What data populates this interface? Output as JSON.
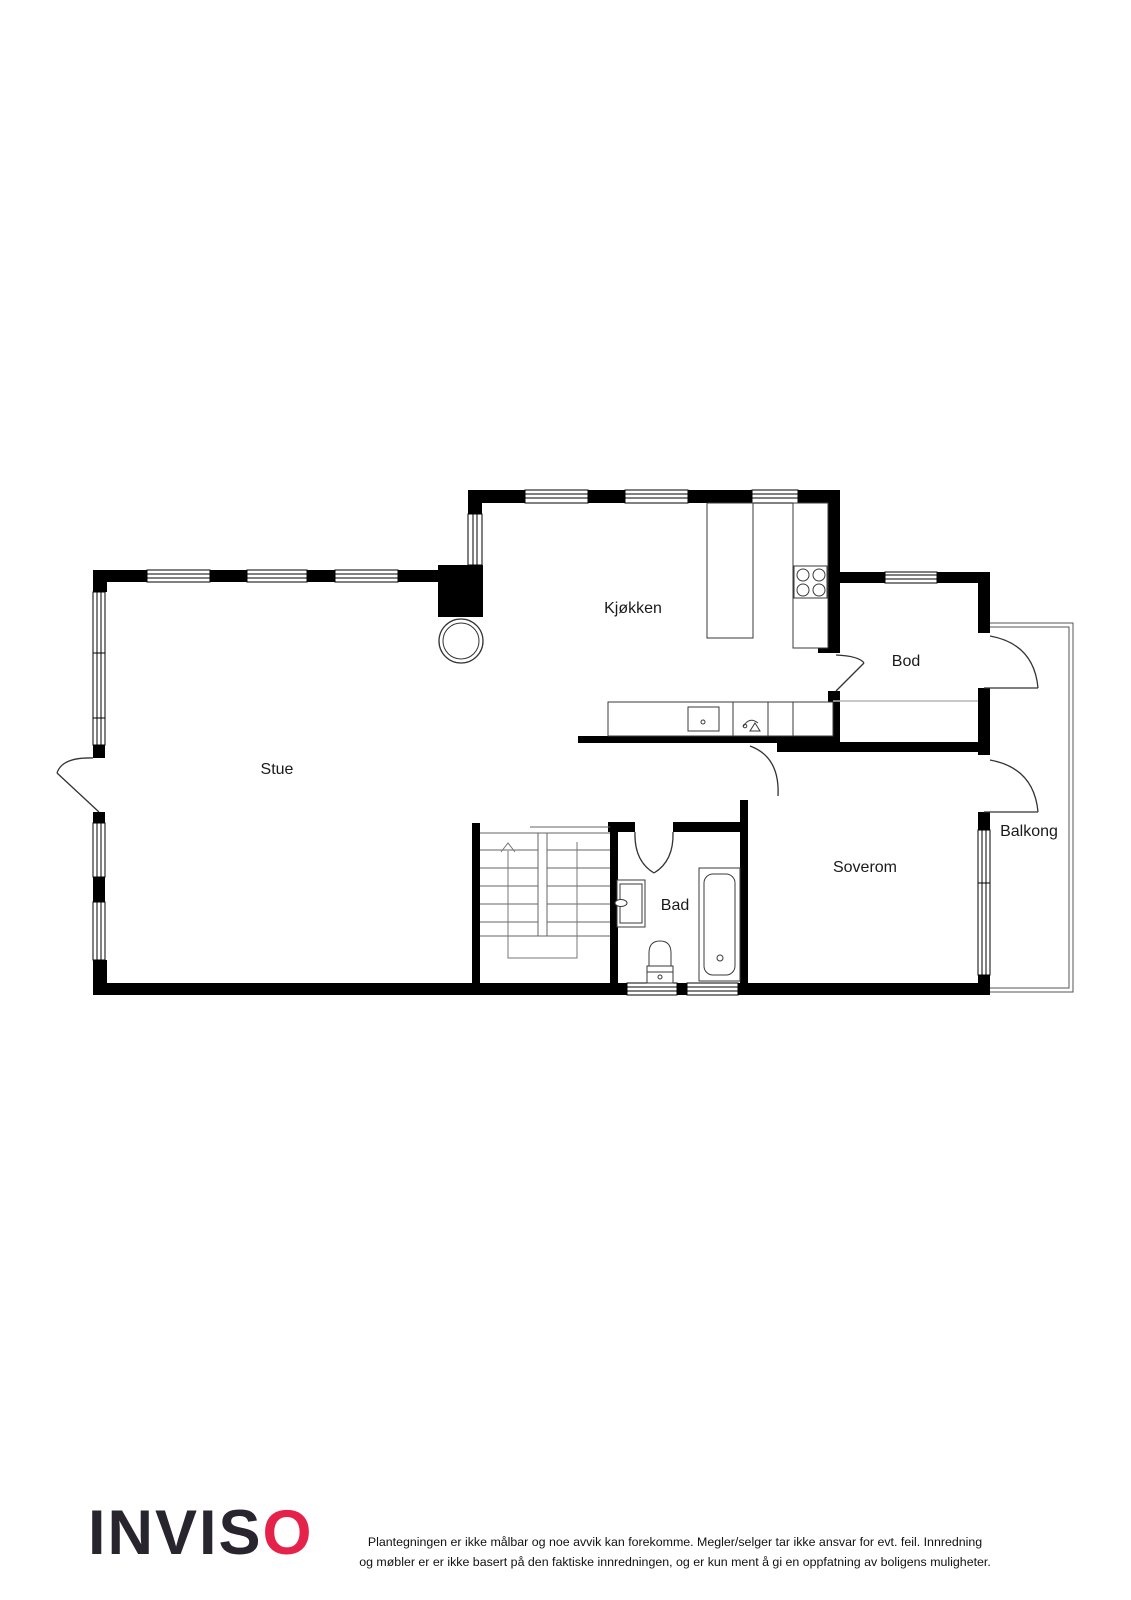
{
  "floor_plan": {
    "rooms": [
      {
        "id": "stue",
        "label": "Stue"
      },
      {
        "id": "kjokken",
        "label": "Kjøkken"
      },
      {
        "id": "bod",
        "label": "Bod"
      },
      {
        "id": "soverom",
        "label": "Soverom"
      },
      {
        "id": "bad",
        "label": "Bad"
      },
      {
        "id": "balkong",
        "label": "Balkong"
      }
    ],
    "stairs": {
      "direction": "up"
    },
    "fixtures": [
      "kitchen-island",
      "stove",
      "kitchen-counter",
      "kitchen-sink",
      "faucet",
      "chimney",
      "bathroom-sink",
      "toilet",
      "bathtub",
      "staircase"
    ]
  },
  "footer": {
    "logo": {
      "text_black": "INVIS",
      "text_red": "O"
    },
    "disclaimer": {
      "line1": "Plantegningen er ikke målbar og noe avvik kan forekomme. Megler/selger tar ikke ansvar for evt. feil. Innredning",
      "line2": "og møbler er er ikke basert på den faktiske innredningen, og er kun ment å gi en oppfatning av boligens muligheter."
    }
  },
  "colors": {
    "wall": "#000000",
    "fixture_line": "#3a3a3a",
    "balcony_outline": "#555555",
    "logo_black": "#29252e",
    "logo_red": "#e5234a"
  }
}
